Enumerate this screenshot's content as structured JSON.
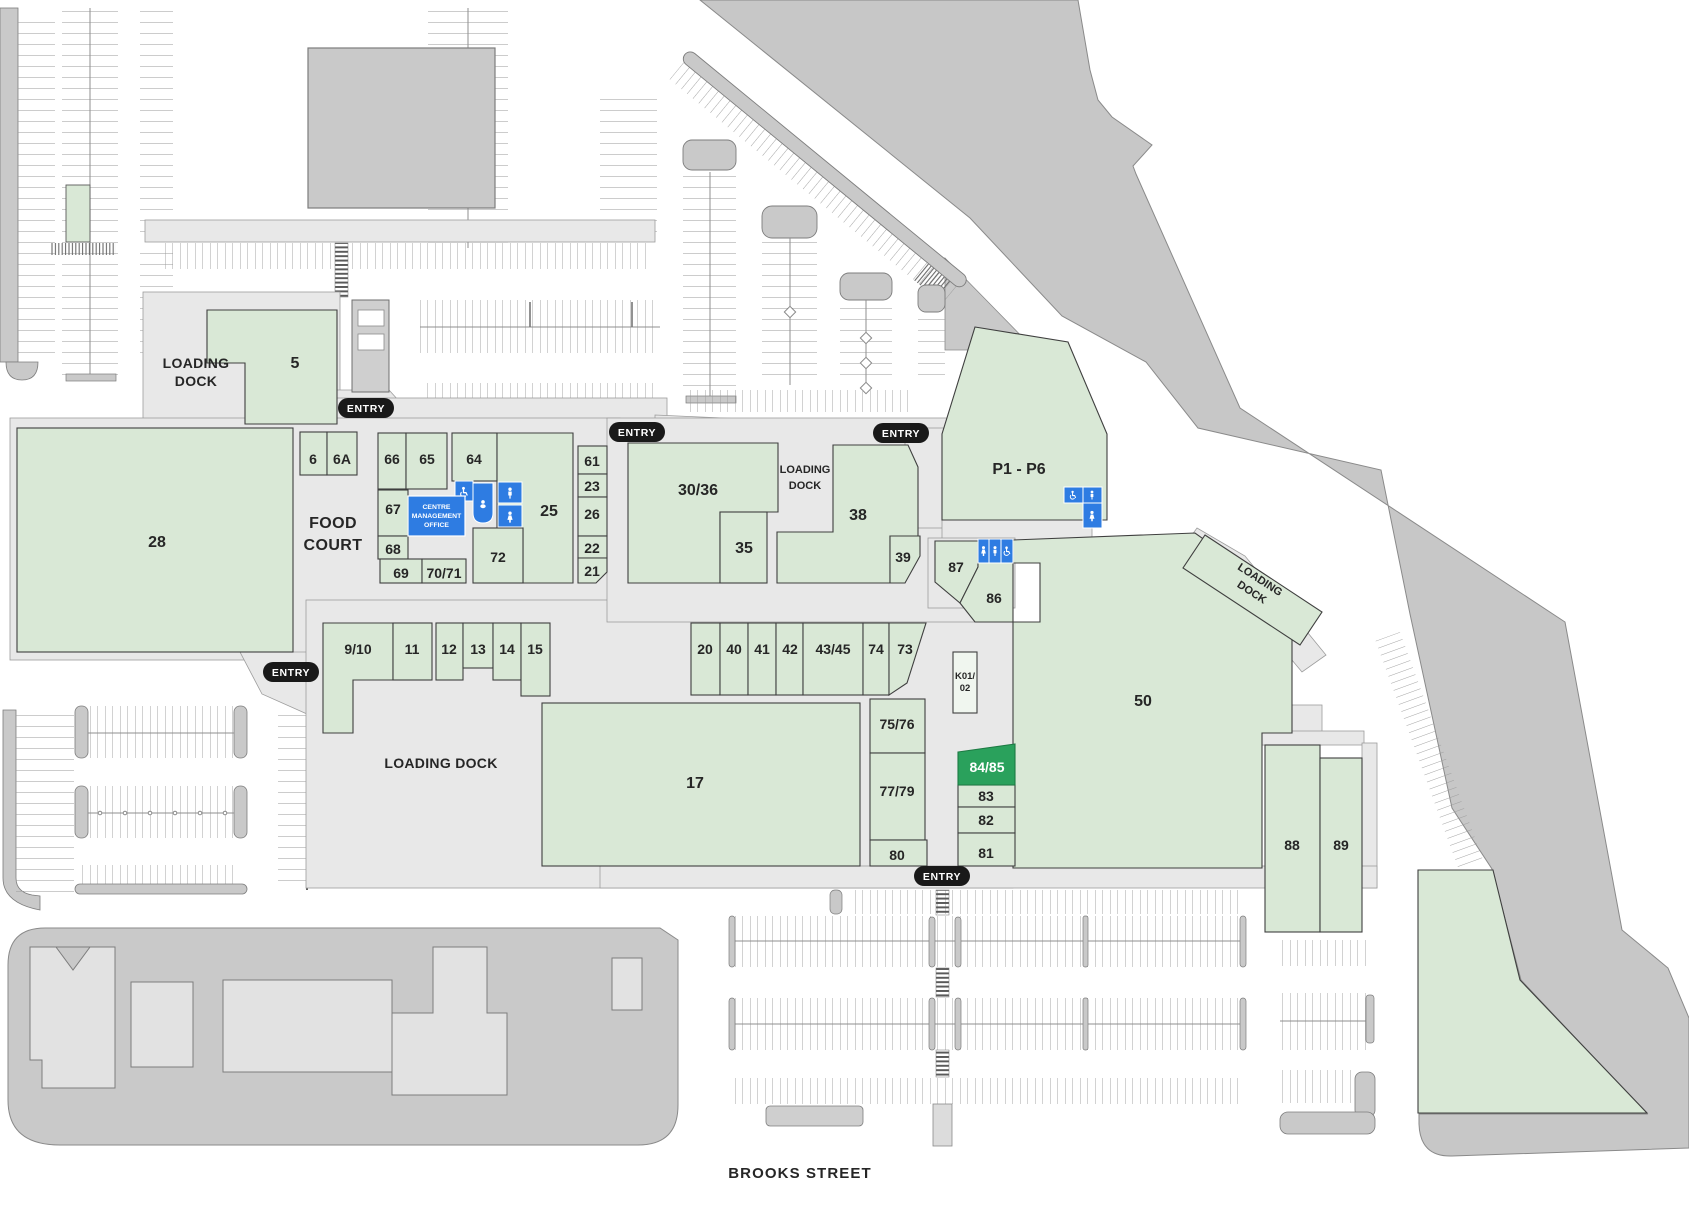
{
  "street": {
    "label": "BROOKS STREET"
  },
  "entry": {
    "label": "ENTRY"
  },
  "areas": {
    "food_court": {
      "line1": "FOOD",
      "line2": "COURT"
    },
    "loading_dock_west": {
      "line1": "LOADING",
      "line2": "DOCK"
    },
    "loading_dock_mid": {
      "line1": "LOADING",
      "line2": "DOCK"
    },
    "loading_dock_south": {
      "label": "LOADING DOCK"
    },
    "loading_dock_east": {
      "line1": "LOADING",
      "line2": "DOCK"
    },
    "management_office": {
      "line1": "CENTRE",
      "line2": "MANAGEMENT",
      "line3": "OFFICE"
    }
  },
  "kiosk": {
    "line1": "K01/",
    "line2": "02"
  },
  "highlighted_store": "84/85",
  "amenities": [
    "wheelchair-accessible-toilet",
    "baby-change",
    "male-toilet",
    "female-toilet"
  ],
  "colors": {
    "store": "#d9e8d6",
    "highlight": "#2aa15c",
    "amenity_blue": "#2e7ce2",
    "ground": "#e8e8e8",
    "landscape": "#c7c7c7",
    "entry_badge": "#191919"
  },
  "stores": [
    {
      "id": "5",
      "label": "5"
    },
    {
      "id": "6",
      "label": "6"
    },
    {
      "id": "6A",
      "label": "6A"
    },
    {
      "id": "66",
      "label": "66"
    },
    {
      "id": "65",
      "label": "65"
    },
    {
      "id": "64",
      "label": "64"
    },
    {
      "id": "25",
      "label": "25"
    },
    {
      "id": "61",
      "label": "61"
    },
    {
      "id": "23",
      "label": "23"
    },
    {
      "id": "26",
      "label": "26"
    },
    {
      "id": "22",
      "label": "22"
    },
    {
      "id": "21",
      "label": "21"
    },
    {
      "id": "67",
      "label": "67"
    },
    {
      "id": "68",
      "label": "68"
    },
    {
      "id": "69",
      "label": "69"
    },
    {
      "id": "70/71",
      "label": "70/71"
    },
    {
      "id": "72",
      "label": "72"
    },
    {
      "id": "28",
      "label": "28"
    },
    {
      "id": "30/36",
      "label": "30/36"
    },
    {
      "id": "35",
      "label": "35"
    },
    {
      "id": "38",
      "label": "38"
    },
    {
      "id": "39",
      "label": "39"
    },
    {
      "id": "87",
      "label": "87"
    },
    {
      "id": "86",
      "label": "86"
    },
    {
      "id": "P1-P6",
      "label": "P1 - P6"
    },
    {
      "id": "50",
      "label": "50"
    },
    {
      "id": "9/10",
      "label": "9/10"
    },
    {
      "id": "11",
      "label": "11"
    },
    {
      "id": "12",
      "label": "12"
    },
    {
      "id": "13",
      "label": "13"
    },
    {
      "id": "14",
      "label": "14"
    },
    {
      "id": "15",
      "label": "15"
    },
    {
      "id": "20",
      "label": "20"
    },
    {
      "id": "40",
      "label": "40"
    },
    {
      "id": "41",
      "label": "41"
    },
    {
      "id": "42",
      "label": "42"
    },
    {
      "id": "43/45",
      "label": "43/45"
    },
    {
      "id": "74",
      "label": "74"
    },
    {
      "id": "73",
      "label": "73"
    },
    {
      "id": "17",
      "label": "17"
    },
    {
      "id": "75/76",
      "label": "75/76"
    },
    {
      "id": "77/79",
      "label": "77/79"
    },
    {
      "id": "80",
      "label": "80"
    },
    {
      "id": "84/85",
      "label": "84/85"
    },
    {
      "id": "83",
      "label": "83"
    },
    {
      "id": "82",
      "label": "82"
    },
    {
      "id": "81",
      "label": "81"
    },
    {
      "id": "88",
      "label": "88"
    },
    {
      "id": "89",
      "label": "89"
    }
  ]
}
